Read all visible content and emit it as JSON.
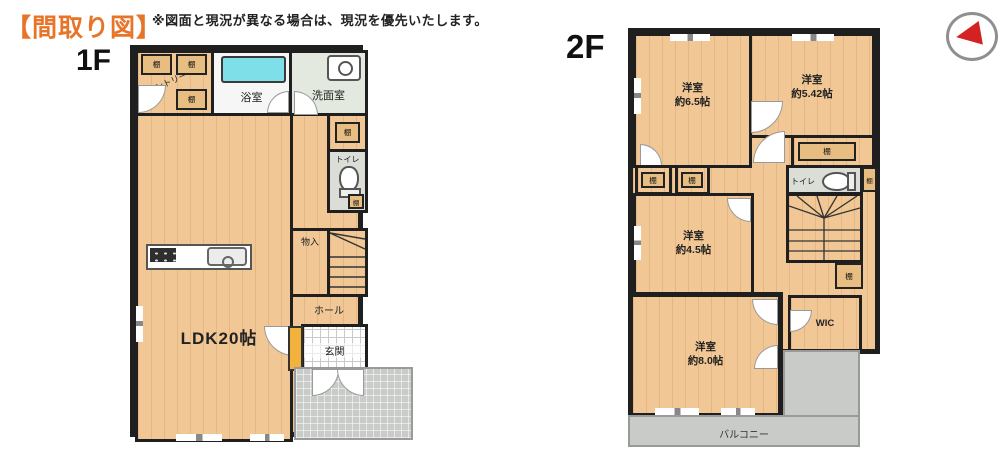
{
  "header": {
    "title": "【間取り図】",
    "disclaimer": "※図面と現況が異なる場合は、現況を優先いたします。"
  },
  "floor1": {
    "label": "1F",
    "rooms": {
      "pantry": "パントリー",
      "bath": "浴室",
      "washroom": "洗面室",
      "toilet": "トイレ",
      "ldk": "LDK20帖",
      "storage": "物入",
      "hall": "ホール",
      "entrance": "玄関"
    },
    "shelf": "棚"
  },
  "floor2": {
    "label": "2F",
    "rooms": {
      "bedroom_a_name": "洋室",
      "bedroom_a_size": "約6.5帖",
      "bedroom_b_name": "洋室",
      "bedroom_b_size": "約5.42帖",
      "bedroom_c_name": "洋室",
      "bedroom_c_size": "約4.5帖",
      "bedroom_d_name": "洋室",
      "bedroom_d_size": "約8.0帖",
      "toilet": "トイレ",
      "wic": "WIC",
      "balcony": "バルコニー"
    },
    "shelf": "棚"
  },
  "colors": {
    "accent_orange": "#e87428",
    "wall": "#1f1f1f",
    "wood_floor": "#f1c795",
    "bathtub_cyan": "#7fdfe9",
    "shoe_cabinet_yellow": "#f2b23c",
    "exterior_gray": "#c9cbc8",
    "compass_red": "#d42222"
  }
}
